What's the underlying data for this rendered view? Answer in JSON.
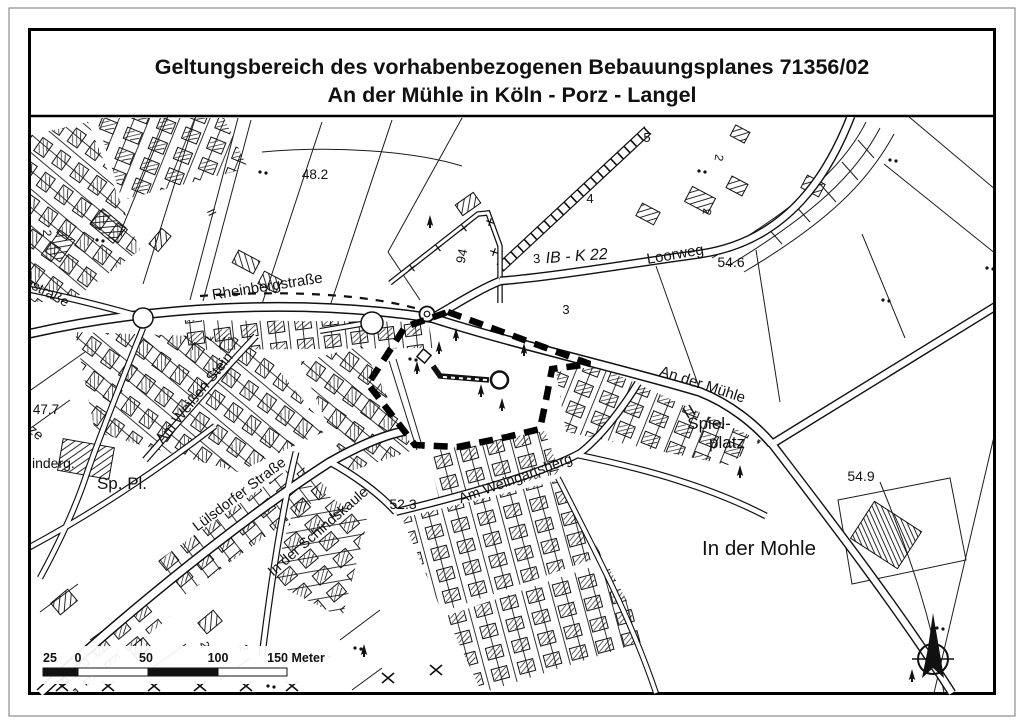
{
  "title": {
    "line1": "Geltungsbereich des vorhabenbezogenen Bebauungsplanes 71356/02",
    "line2": "An der Mühle in Köln - Porz - Langel"
  },
  "streets": {
    "rheinbergstrasse": "Rheinbergstraße",
    "loorweg": "Loorweg",
    "an_der_muehle": "An der Mühle",
    "am_weissen_stein": "Am Weißen Stein",
    "luelsdorfer_strasse": "Lülsdorfer Straße",
    "in_der_schindskaule": "In der Schindskaule",
    "am_weingartsberg": "Am Weingartsberg",
    "gstrasse_partial": "gstraße",
    "ze_partial": "ze"
  },
  "places": {
    "spielplatz_line1": "Spiel-",
    "spielplatz_line2": "platz",
    "in_der_mohle": "In der Mohle",
    "sp_pl": "Sp. Pl.",
    "kindergarten_partial": "inderg."
  },
  "elevations": {
    "e48_2": "48.2",
    "e54_6": "54.6",
    "e54_9": "54.9",
    "e47_7": "47.7",
    "e52_3": "52.3"
  },
  "refs": {
    "ib_k22": "IB - K 22"
  },
  "numbers": {
    "n3a": "3",
    "n3b": "3",
    "n4": "4",
    "n5": "5",
    "n94": "94",
    "two_a": "2",
    "two_b": "2",
    "two_c": "2",
    "two_d": "2",
    "two_e": "2",
    "roman_ii": "II",
    "l_mark": "L"
  },
  "scalebar": {
    "t25": "25",
    "t0": "0",
    "t50": "50",
    "t100": "100",
    "t150": "150 Meter"
  },
  "compass": {
    "n": "N"
  },
  "colors": {
    "ink": "#111111",
    "paper": "#ffffff",
    "frame": "#000000"
  }
}
